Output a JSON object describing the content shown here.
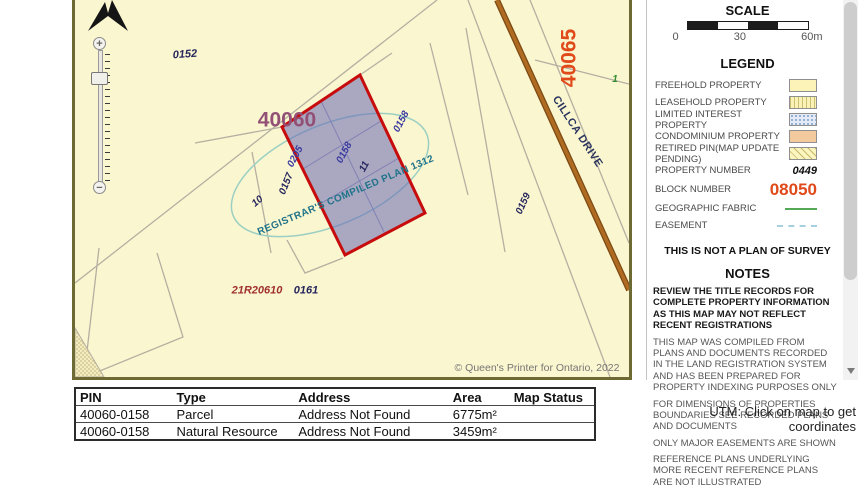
{
  "map": {
    "block_labels": {
      "b40060": "40060",
      "b40065": "40065"
    },
    "parcel_labels": {
      "p0152": "0152",
      "p0157": "0157",
      "p0158a": "0158",
      "p0158b": "0158",
      "p0159": "0159",
      "p0161": "0161",
      "p0205": "0205",
      "p10": "10",
      "p11": "11",
      "fabric1": "1"
    },
    "road_name": "CILLCA DRIVE",
    "plan_text": "REGISTRAR'S COMPILED PLAN 1312",
    "ref_plan": "21R20610",
    "copyright": "© Queen's Printer for Ontario, 2022",
    "zoom_in": "+",
    "zoom_out": "−"
  },
  "panel": {
    "scale": {
      "title": "SCALE",
      "t0": "0",
      "t30": "30",
      "t60": "60m"
    },
    "legend": {
      "title": "LEGEND",
      "items": [
        {
          "label": "FREEHOLD PROPERTY"
        },
        {
          "label": "LEASEHOLD PROPERTY"
        },
        {
          "label": "LIMITED INTEREST PROPERTY"
        },
        {
          "label": "CONDOMINIUM PROPERTY"
        },
        {
          "label": "RETIRED PIN(MAP UPDATE PENDING)"
        }
      ],
      "property_number_label": "PROPERTY NUMBER",
      "property_number_value": "0449",
      "block_number_label": "BLOCK NUMBER",
      "block_number_value": "08050",
      "geographic_fabric_label": "GEOGRAPHIC FABRIC",
      "easement_label": "EASEMENT"
    },
    "survey_notice": "THIS IS NOT A PLAN OF SURVEY",
    "notes": {
      "title": "NOTES",
      "warning": "REVIEW THE TITLE RECORDS FOR COMPLETE PROPERTY INFORMATION AS THIS MAP MAY NOT REFLECT RECENT REGISTRATIONS",
      "paragraphs": [
        "THIS MAP WAS COMPILED FROM PLANS AND DOCUMENTS RECORDED IN THE LAND REGISTRATION SYSTEM AND HAS BEEN PREPARED FOR PROPERTY INDEXING PURPOSES ONLY",
        "FOR DIMENSIONS OF PROPERTIES BOUNDARIES SEE RECORDED PLANS AND DOCUMENTS",
        "ONLY MAJOR EASEMENTS ARE SHOWN",
        "REFERENCE PLANS UNDERLYING MORE RECENT REFERENCE PLANS ARE NOT ILLUSTRATED"
      ]
    }
  },
  "results_table": {
    "headers": [
      "PIN",
      "Type",
      "Address",
      "Area",
      "Map Status"
    ],
    "rows": [
      {
        "pin": "40060-0158",
        "type": "Parcel",
        "address": "Address Not Found",
        "area": "6775m²",
        "status": ""
      },
      {
        "pin": "40060-0158",
        "type": "Natural Resource",
        "address": "Address Not Found",
        "area": "3459m²",
        "status": ""
      }
    ]
  },
  "utm_hint": "UTM: Click on map to get coordinates",
  "colors": {
    "freehold_fill": "#FAF6CF",
    "highlight_fill": "#6868b6",
    "highlight_border": "#C60C0C",
    "road": "#AF6B22",
    "block_number": "#E0491A",
    "geographic_fabric": "#55A855"
  }
}
